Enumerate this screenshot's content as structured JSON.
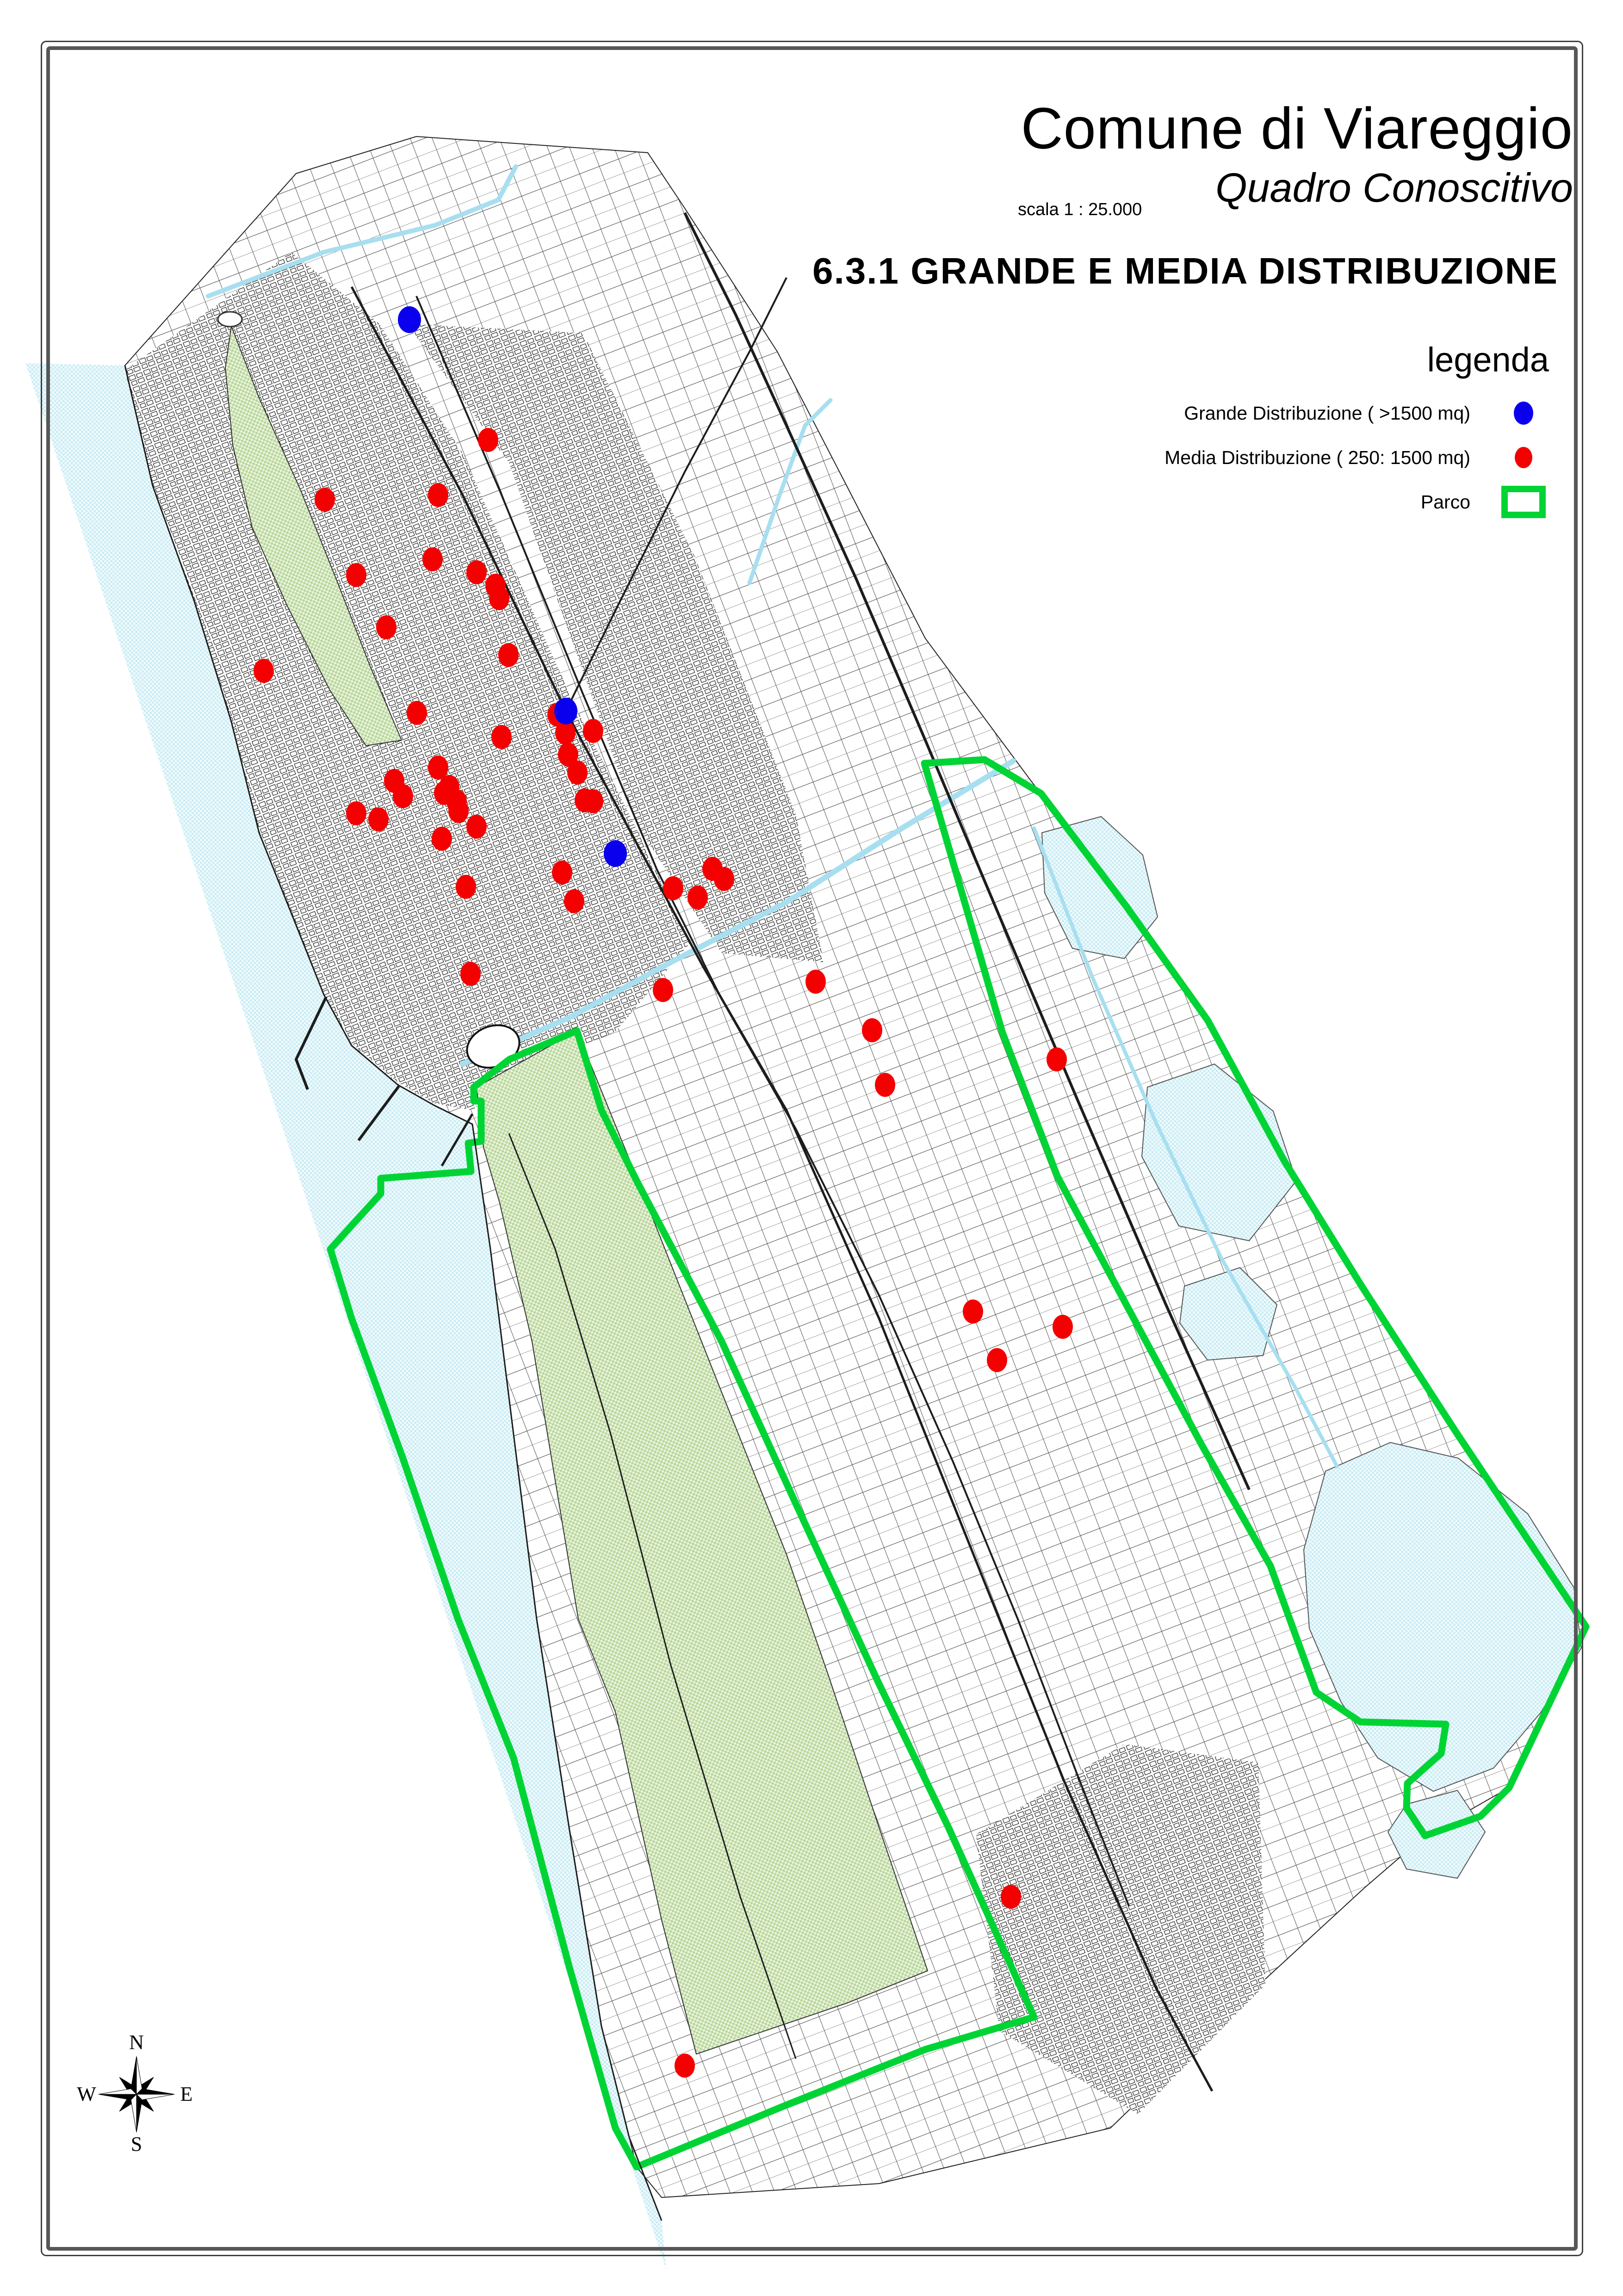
{
  "header": {
    "title": "Comune di Viareggio",
    "subtitle": "Quadro Conoscitivo",
    "scale_label": "scala 1 : 25.000",
    "section_title": "6.3.1  GRANDE E MEDIA DISTRIBUZIONE"
  },
  "legend": {
    "title": "legenda",
    "items": [
      {
        "label": "Grande Distribuzione ( >1500 mq)",
        "symbol": "dot",
        "color_key": "grande"
      },
      {
        "label": "Media Distribuzione ( 250: 1500 mq)",
        "symbol": "dot",
        "color_key": "media"
      },
      {
        "label": "Parco",
        "symbol": "rect-outline",
        "color_key": "parco"
      }
    ]
  },
  "compass": {
    "north": "N",
    "east": "E",
    "south": "S",
    "west": "W"
  },
  "map": {
    "colors": {
      "grande": "#0b00ee",
      "media": "#f40000",
      "parco": "#00d435",
      "park_fill": "#b7d69a",
      "park_bg": "#eaf3dd",
      "water": "#c9ecf4",
      "water_bg": "#f2fbfd",
      "water_line": "#a7dff0"
    },
    "grande_distribuzione": {
      "dot_rx": 25,
      "dot_ry": 29,
      "points": [
        [
          885,
          691
        ],
        [
          1223,
          1537
        ],
        [
          1330,
          1845
        ]
      ]
    },
    "media_distribuzione": {
      "dot_rx": 22,
      "dot_ry": 26,
      "points": [
        [
          1055,
          951
        ],
        [
          947,
          1070
        ],
        [
          702,
          1080
        ],
        [
          935,
          1209
        ],
        [
          770,
          1243
        ],
        [
          1030,
          1237
        ],
        [
          1071,
          1266
        ],
        [
          1079,
          1293
        ],
        [
          835,
          1356
        ],
        [
          1099,
          1416
        ],
        [
          570,
          1450
        ],
        [
          901,
          1541
        ],
        [
          1205,
          1545
        ],
        [
          1222,
          1584
        ],
        [
          1282,
          1580
        ],
        [
          1084,
          1593
        ],
        [
          1228,
          1631
        ],
        [
          1248,
          1670
        ],
        [
          947,
          1659
        ],
        [
          852,
          1688
        ],
        [
          971,
          1701
        ],
        [
          871,
          1721
        ],
        [
          960,
          1714
        ],
        [
          987,
          1732
        ],
        [
          1264,
          1730
        ],
        [
          1282,
          1732
        ],
        [
          770,
          1758
        ],
        [
          818,
          1771
        ],
        [
          991,
          1753
        ],
        [
          1030,
          1787
        ],
        [
          955,
          1813
        ],
        [
          1215,
          1886
        ],
        [
          1007,
          1917
        ],
        [
          1241,
          1948
        ],
        [
          1540,
          1878
        ],
        [
          1565,
          1900
        ],
        [
          1455,
          1920
        ],
        [
          1508,
          1940
        ],
        [
          1017,
          2105
        ],
        [
          1433,
          2140
        ],
        [
          1763,
          2122
        ],
        [
          1885,
          2227
        ],
        [
          2284,
          2290
        ],
        [
          1913,
          2345
        ],
        [
          2103,
          2835
        ],
        [
          2297,
          2868
        ],
        [
          2155,
          2940
        ],
        [
          2185,
          4100
        ],
        [
          1480,
          4465
        ]
      ]
    }
  }
}
